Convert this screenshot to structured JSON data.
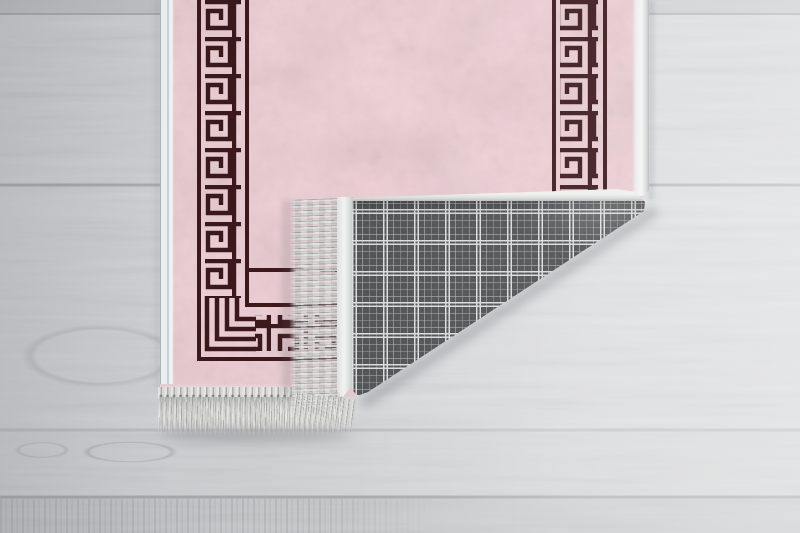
{
  "meta": {
    "alt": "Top-down product photo of a pink velvet rug with a dark Greek-key meander border lying on a whitewashed wooden plank floor; the bottom-right corner is folded over, showing the grey plaid woven backing, white edge binding and pale fringe tassels"
  },
  "palette": {
    "pink-base": "#f0d0d6",
    "pink-dark": "#dfa8b1",
    "pink-light": "#f7dfe2",
    "border-dark": "#3a181c",
    "binding-white": "#f0f2f1",
    "fringe-light": "#dcdcda",
    "fringe-mid": "#c9c9c7",
    "fringe-dark": "#a5a5a3",
    "plaid-base": "#4b4c4e",
    "plaid-bright": "#d9dadb",
    "plaid-faint": "#909294",
    "floor-light": "#e6e7e9",
    "floor-mid": "#d5d6d8",
    "floor-dark": "#c4c6c8",
    "floor-seam": "#a9abad"
  },
  "scene": {
    "floor": {
      "material": "whitewashed wood planks, horizontal",
      "plank_seams_y": [
        14,
        185,
        430,
        497
      ],
      "features": [
        "knots lower-left",
        "darker streaked plank at bottom-left",
        "brighter light toward right side"
      ]
    },
    "rug": {
      "front": "mottled pink velvet",
      "border_pattern": "greek-key meander bands with thin frame lines, vertical on left and right, turning horizontal along bottom-left corner",
      "edges": "white flat binding on all sides, fringe tassels on bottom end",
      "fold": "bottom-right corner folded over toward upper-left",
      "backing": "grey tartan plaid weave with double bright grid lines",
      "fringe_on_fold": "points left, drooping downward at the tip"
    }
  }
}
